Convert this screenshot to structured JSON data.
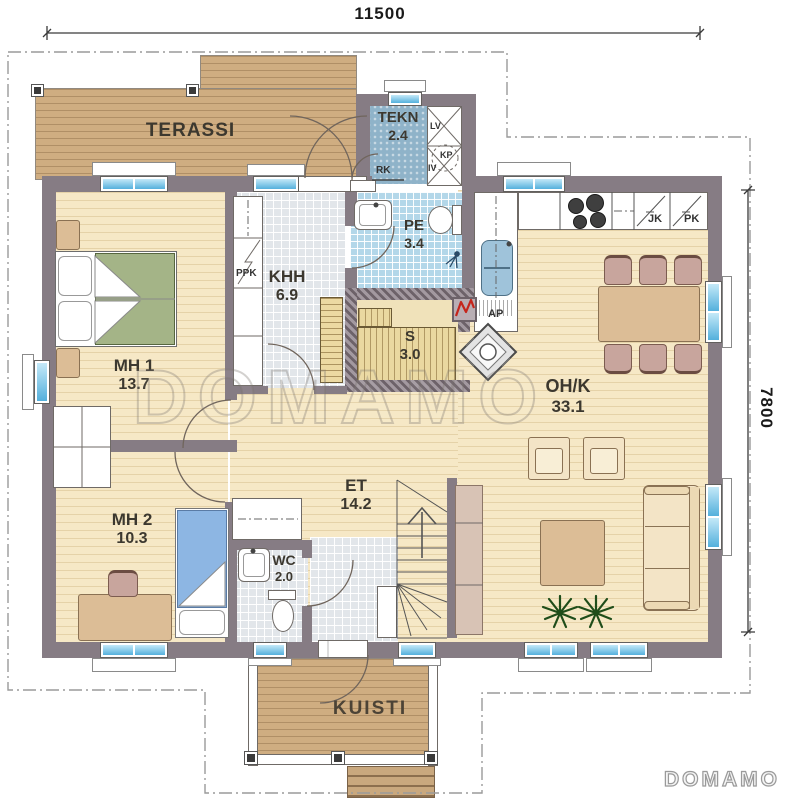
{
  "dimensions": {
    "top": "11500",
    "right": "7800"
  },
  "rooms": {
    "terassi": {
      "name": "TERASSI"
    },
    "tekn": {
      "name": "TEKN",
      "area": "2.4"
    },
    "pe": {
      "name": "PE",
      "area": "3.4"
    },
    "khh": {
      "name": "KHH",
      "area": "6.9"
    },
    "sauna": {
      "name": "S",
      "area": "3.0"
    },
    "ohk": {
      "name": "OH/K",
      "area": "33.1"
    },
    "mh1": {
      "name": "MH 1",
      "area": "13.7"
    },
    "mh2": {
      "name": "MH 2",
      "area": "10.3"
    },
    "et": {
      "name": "ET",
      "area": "14.2"
    },
    "wc": {
      "name": "WC",
      "area": "2.0"
    },
    "kuisti": {
      "name": "KUISTI"
    }
  },
  "appliances": {
    "lv": "LV",
    "kp": "KP",
    "iv": "IV",
    "rk": "RK",
    "ppk": "PPK",
    "jk": "JK",
    "pk": "PK",
    "ap": "AP"
  },
  "watermark": {
    "text": "DOMAMO"
  },
  "logo": {
    "text": "DOMAMO"
  },
  "colors": {
    "wall": "#867c84",
    "wood_deck": "#cfad81",
    "floor_wood": "#f6e8c6",
    "tile_blue": "#b3d7e9",
    "tile_gray": "#e2e6ea",
    "window_glass": "#54b0dc",
    "bed_green": "#a4b487",
    "bed_blue": "#8db6e3",
    "furniture_tan": "#dcbd96",
    "heater_red": "#c5251c",
    "sauna_wood": "#ead8a0",
    "tekn_floor": "#8fb3c9"
  }
}
